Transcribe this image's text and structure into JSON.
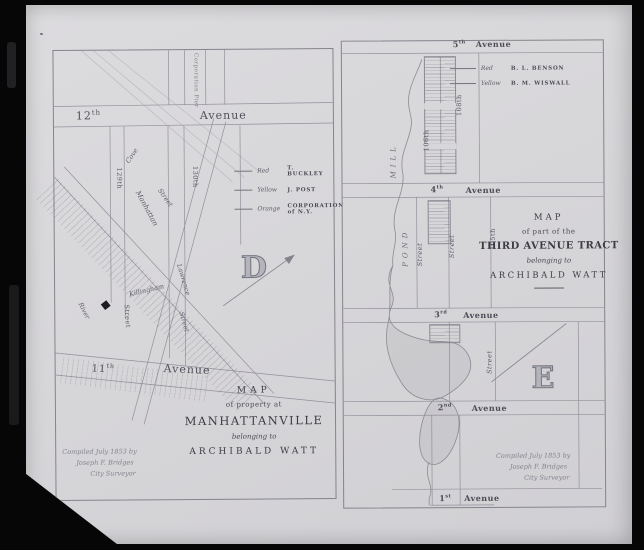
{
  "left_map": {
    "plate_letter": "D",
    "labels": {
      "corporation_pier": "Corporation Pier",
      "avenue12_num": "12",
      "avenue12_suf": "th",
      "avenue11_num": "11",
      "avenue11_suf": "th",
      "avenue_word": "Avenue",
      "cove": "Cove",
      "street129": "129th",
      "street130": "130th",
      "street_word": "Street",
      "manhattan": "Manhattan",
      "killingham": "Killingham",
      "lawrence": "Lawrence",
      "river": "River"
    },
    "legend": [
      {
        "color": "Red",
        "name": "T. BUCKLEY"
      },
      {
        "color": "Yellow",
        "name": "J. POST"
      },
      {
        "color": "Orange",
        "name": "CORPORATION of N.Y."
      }
    ],
    "title": {
      "map": "MAP",
      "of": "of property at",
      "place": "MANHATTANVILLE",
      "belonging": "belonging to",
      "owner": "ARCHIBALD WATT"
    },
    "credit": {
      "compiled": "Compiled July 1853 by",
      "surveyor": "Joseph F. Bridges",
      "role": "City Surveyor"
    }
  },
  "right_map": {
    "plate_letter": "E",
    "labels": {
      "avenue5_num": "5",
      "avenue5_suf": "th",
      "avenue4_num": "4",
      "avenue4_suf": "th",
      "avenue3_num": "3",
      "avenue3_suf": "rd",
      "avenue2_num": "2",
      "avenue2_suf": "nd",
      "avenue1_num": "1",
      "avenue1_suf": "st",
      "avenue_word": "Avenue",
      "street105": "105th",
      "street106": "106th",
      "street108": "108th",
      "street_word": "Street",
      "mill": "MILL",
      "pond": "POND"
    },
    "legend": [
      {
        "color": "Red",
        "name": "B. L. BENSON"
      },
      {
        "color": "Yellow",
        "name": "B. M. WISWALL"
      }
    ],
    "title": {
      "map": "MAP",
      "of": "of part of the",
      "place": "THIRD AVENUE TRACT",
      "belonging": "belonging to",
      "owner": "ARCHIBALD WATT"
    },
    "credit": {
      "compiled": "Compiled July 1853 by",
      "surveyor": "Joseph F. Bridges",
      "role": "City Surveyor"
    }
  }
}
